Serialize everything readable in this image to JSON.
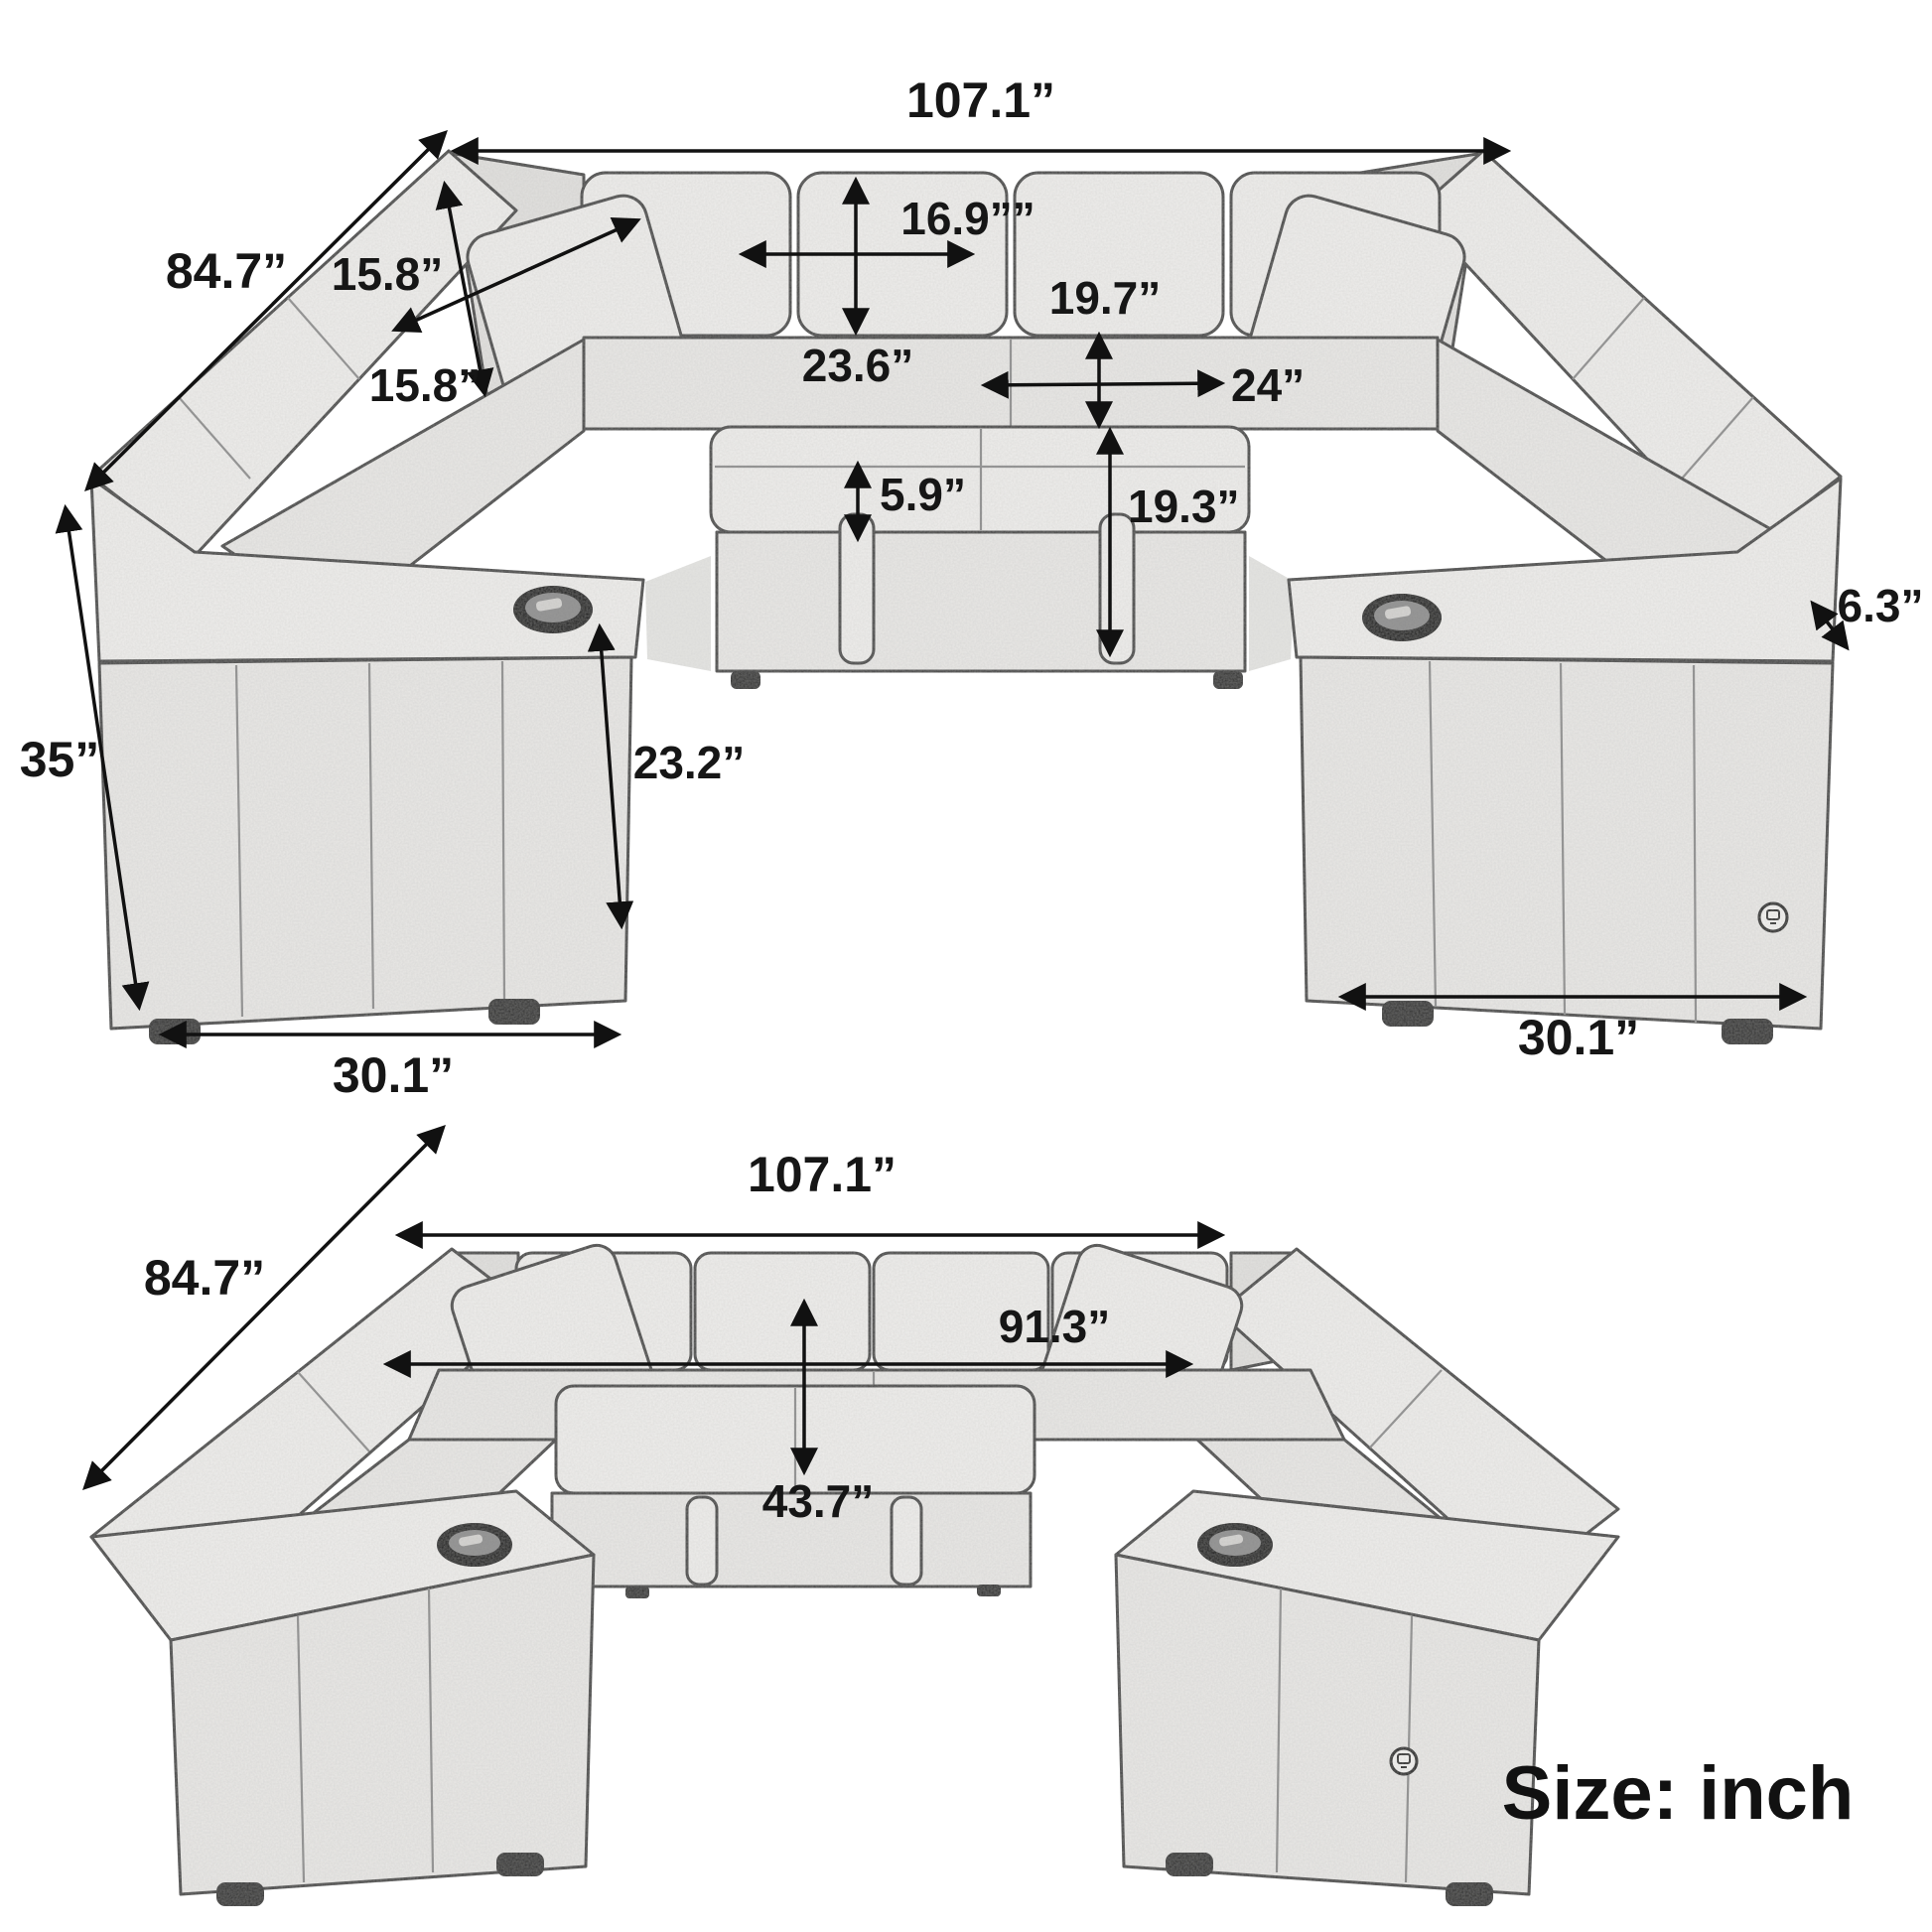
{
  "page": {
    "background": "#ffffff",
    "unit_note": "Size: inch"
  },
  "palette": {
    "outline": "#454545",
    "dim_line": "#111111",
    "fabric_light": "#efeeec",
    "fabric_mid": "#e9e8e6",
    "fabric_shadow": "#d6d5d3",
    "text": "#161616"
  },
  "top_view": {
    "name": "U-shaped modular sleeper sectional, front perspective with dimensions",
    "dims": {
      "overall_width": "107.1”",
      "diagonal_depth": "84.7”",
      "pillow_width": "15.8”",
      "pillow_height": "15.8”",
      "back_cushion_width": "16.9””",
      "backrest_height": "23.6”",
      "seat_depth": "19.7”",
      "seat_width": "24”",
      "cushion_thickness": "5.9”",
      "seat_height": "19.3”",
      "overall_height": "35”",
      "arm_height": "23.2”",
      "arm_depth_left": "30.1”",
      "arm_depth_right": "30.1”",
      "arm_width": "6.3”"
    }
  },
  "bottom_view": {
    "name": "U-shaped modular sleeper sectional, raised perspective with dimensions",
    "dims": {
      "overall_width": "107.1”",
      "diagonal_depth": "84.7”",
      "inner_width": "91.3”",
      "inner_depth": "43.7”"
    }
  }
}
